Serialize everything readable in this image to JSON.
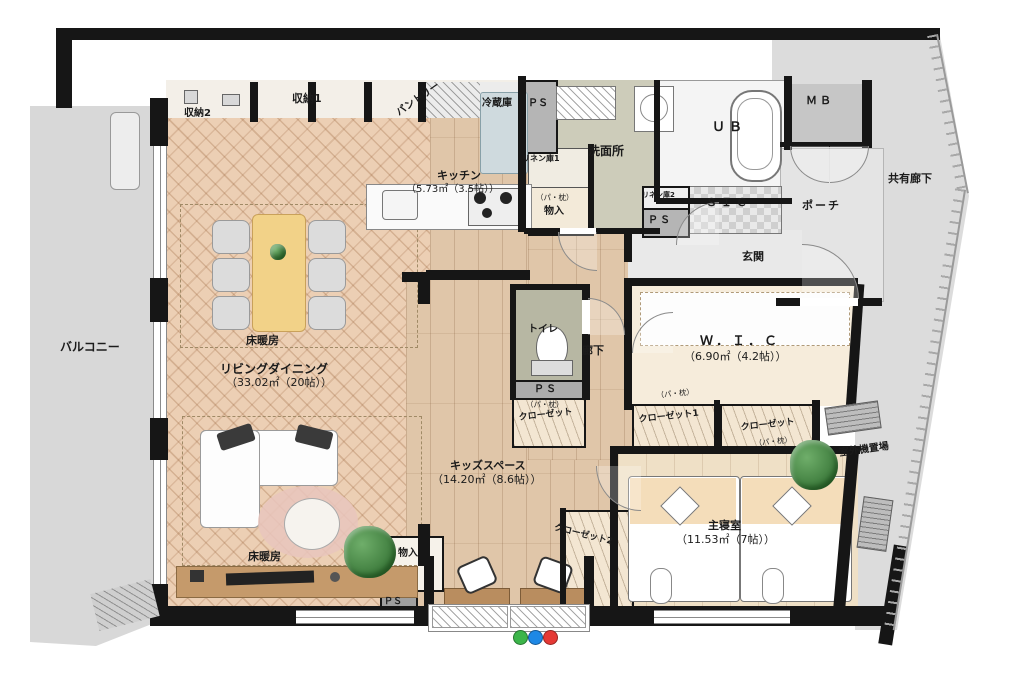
{
  "labels": {
    "balcony": "バルコニー",
    "storage2": "収納2",
    "storage1": "収納1",
    "pantry": "パントリー",
    "refrigerator": "冷蔵庫",
    "ps_top": "ＰＳ",
    "kitchen": "キッチン",
    "kitchen_area": "（5.73㎡（3.5帖））",
    "linen1": "リネン庫1",
    "washroom": "洗面所",
    "unit_bath": "ＵＢ",
    "meter_box": "ＭＢ",
    "porch": "ポーチ",
    "shared_corridor": "共有廊下",
    "entrance": "玄関",
    "sic": "ＳＩＣ",
    "linen2": "リネン庫2",
    "ps_entrance": "ＰＳ",
    "storage_note": "（パ・枕）",
    "monoire": "物入",
    "toilet": "トイレ",
    "hallway": "廊下",
    "ps_hall": "ＰＳ",
    "closet_hall": "クローゼット",
    "wic": "Ｗ．Ｉ．Ｃ",
    "wic_area": "（6.90㎡（4.2帖））",
    "closet1": "クローゼット1",
    "closet_right": "クローゼット",
    "floor_heating": "床暖房",
    "living_dining": "リビングダイニング",
    "living_dining_area": "（33.02㎡（20帖））",
    "kids_space": "キッズスペース",
    "kids_space_area": "（14.20㎡（8.6帖））",
    "master_bedroom": "主寝室",
    "master_bedroom_area": "（11.53㎡（7帖））",
    "closet2": "クローゼット2",
    "monoire_kids": "物入",
    "ps_bottom": "ＰＳ",
    "outdoor_unit": "室外機置場"
  },
  "colors": {
    "wall": "#161616",
    "herringbone_floor": "#eccfb4",
    "wood_floor": "#e0c6a9",
    "dining_table": "#f2d288",
    "washroom_floor": "#cdccba",
    "shared_area": "#dcdcdc",
    "marker_green": "#3cb54a",
    "marker_blue": "#1e88e5",
    "marker_red": "#e53935"
  }
}
